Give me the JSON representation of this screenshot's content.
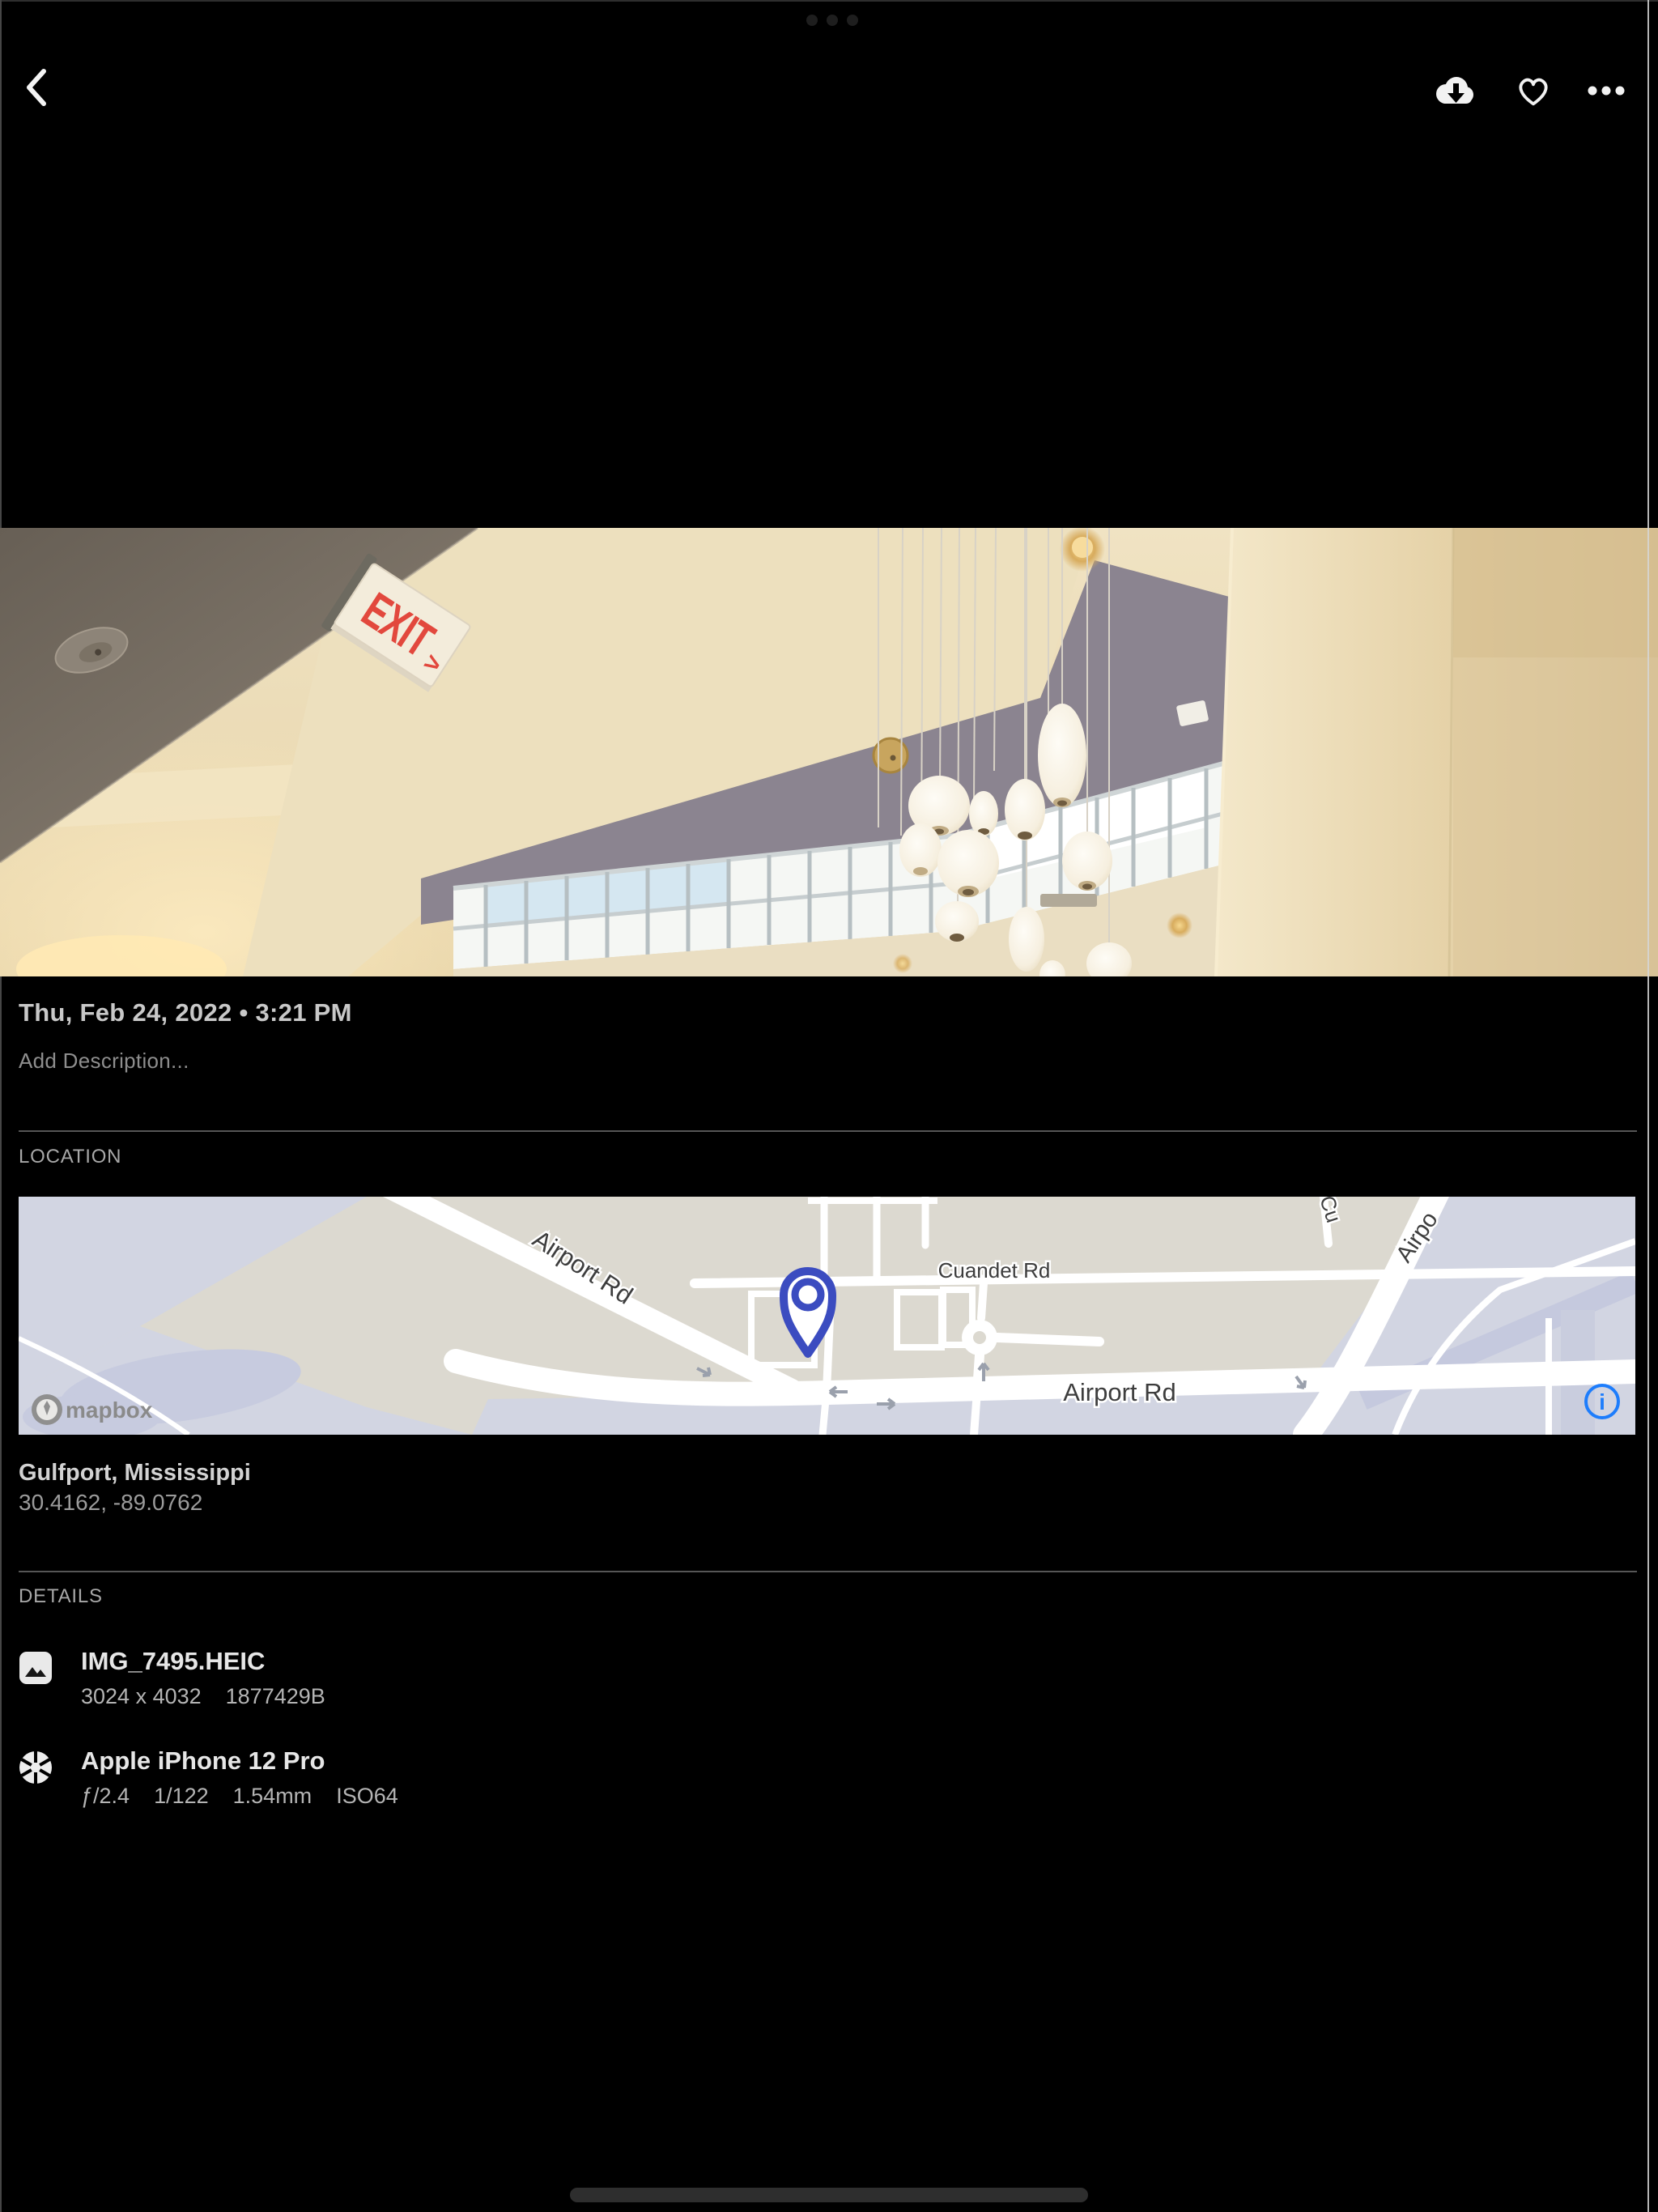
{
  "topbar": {
    "back_icon": "chevron-left",
    "download_icon": "cloud-download",
    "favorite_icon": "heart-outline",
    "more_icon": "ellipsis"
  },
  "photo": {
    "datetime": "Thu, Feb 24, 2022 • 3:21 PM",
    "description_placeholder": "Add Description...",
    "exit_sign_text": "EXIT",
    "exit_sign_arrow": ">"
  },
  "location": {
    "header": "LOCATION",
    "place": "Gulfport, Mississippi",
    "coordinates": "30.4162, -89.0762",
    "map": {
      "labels": {
        "airport_rd_diagonal": "Airport Rd",
        "cuandet_rd": "Cuandet Rd",
        "airport_rd_horizontal": "Airport Rd",
        "airport_rd_partial": "Airpo",
        "cu_partial": "Cu"
      },
      "attribution": "mapbox",
      "info_glyph": "i",
      "colors": {
        "land": "#dcd9d0",
        "water": "#d2d5e2",
        "road": "#ffffff",
        "pin": "#3b4cc0",
        "info": "#1d7dfc"
      }
    }
  },
  "details": {
    "header": "DETAILS",
    "rows": [
      {
        "icon": "image-icon",
        "title": "IMG_7495.HEIC",
        "meta_parts": [
          "3024 x 4032",
          "1877429B"
        ]
      },
      {
        "icon": "aperture-icon",
        "title": "Apple iPhone 12 Pro",
        "meta_parts": [
          "ƒ/2.4",
          "1/122",
          "1.54mm",
          "ISO64"
        ]
      }
    ]
  }
}
